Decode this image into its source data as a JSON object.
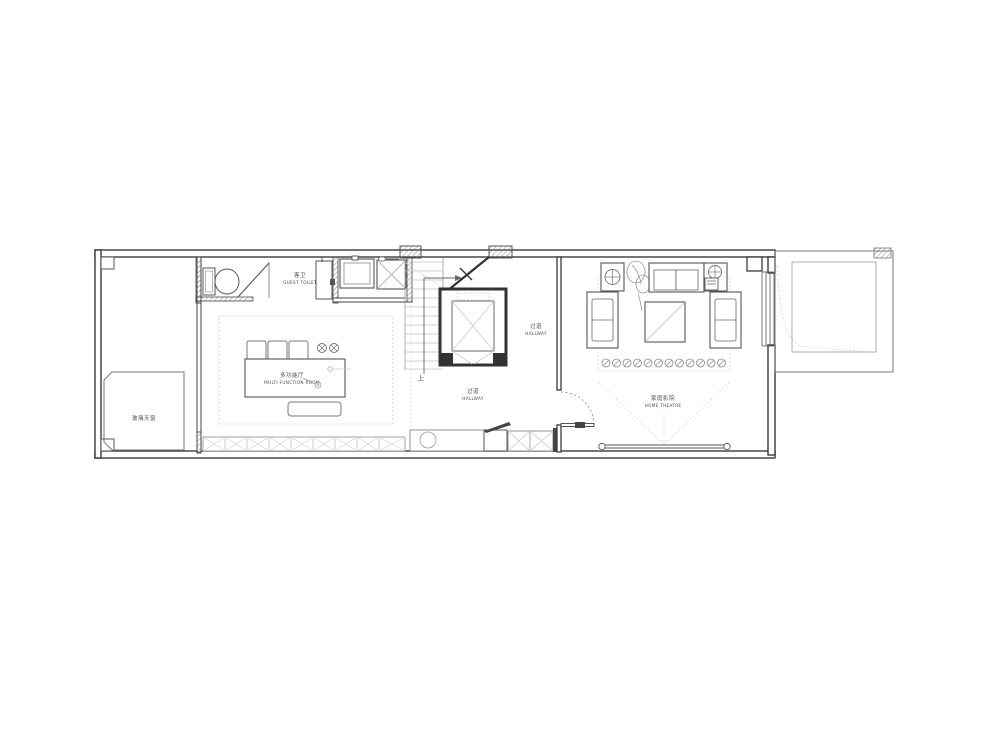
{
  "plan": {
    "title": "floor-plan",
    "labels": {
      "guest_toilet": {
        "zh": "客卫",
        "en": "GUEST TOILET"
      },
      "multi_function_room": {
        "zh": "多功能厅",
        "en": "MULTI-FUNCTION ROOM"
      },
      "hallway_upper": {
        "zh": "过道",
        "en": "HALLWAY"
      },
      "hallway_lower": {
        "zh": "过道",
        "en": "HALLWAY"
      },
      "home_theatre": {
        "zh": "家庭影院",
        "en": "HOME THEATRE"
      },
      "glass_skylight": {
        "zh": "玻璃天窗"
      },
      "stair_direction": "上"
    },
    "fixtures": [
      "toilet",
      "shower-screen",
      "vanity-cabinet",
      "basin",
      "washing-machine",
      "staircase",
      "elevator",
      "storage-cabinet-row",
      "hall-counter-with-sink",
      "shoe-cabinet",
      "wardrobe-boxes",
      "door-swing",
      "side-table-with-lamp",
      "plant",
      "two-seat-sofa",
      "armchair",
      "center-table",
      "speaker-row",
      "projection-screen",
      "window",
      "terrace",
      "roof-hatch-columns"
    ],
    "colors": {
      "wall": "#3a3a3a",
      "medium": "#666666",
      "light": "#9a9a9a",
      "faint": "#c9c9c9",
      "background": "#ffffff"
    }
  }
}
